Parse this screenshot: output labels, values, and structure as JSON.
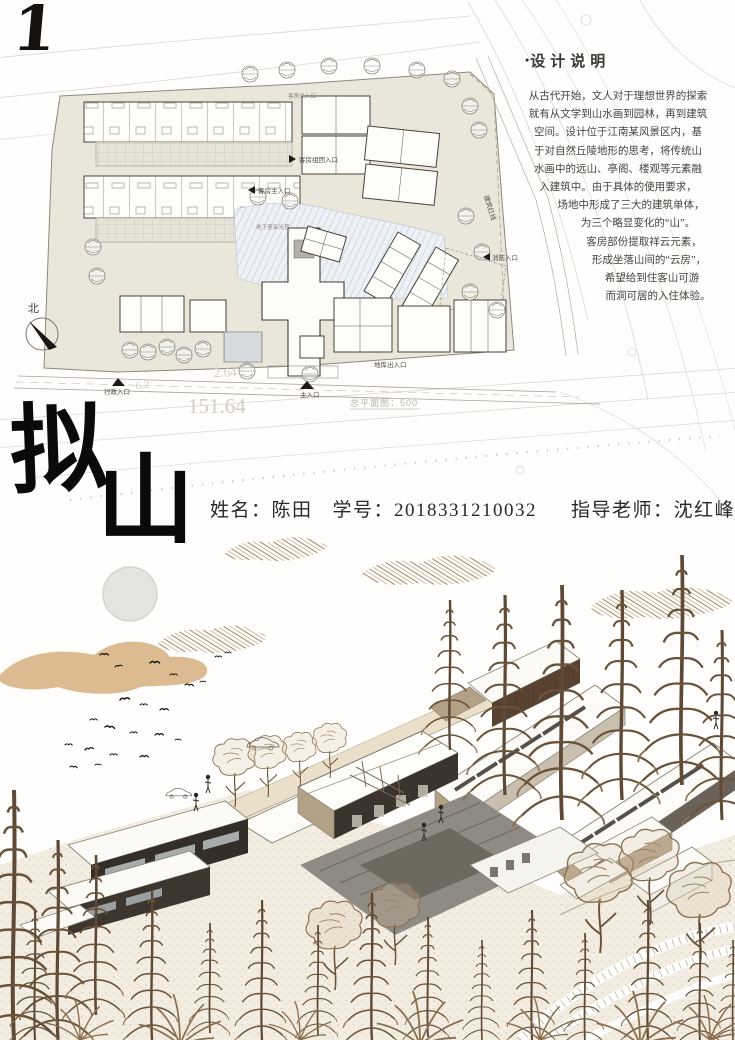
{
  "board": {
    "sheet_number": "1",
    "title": {
      "char1": "拟",
      "char2": "山"
    },
    "student": {
      "name_label": "姓名：",
      "name": "陈田",
      "id_label": "学号：",
      "id": "2018331210032",
      "advisor_label": "指导老师：",
      "advisor": "沈红峰"
    }
  },
  "design_notes": {
    "bullet": "•",
    "title": "设计说明",
    "lines": [
      "从古代开始，文人对于理想世界的探索",
      "就有从文学到山水画到园林，再到建筑",
      "空间。设计位于江南某风景区内，基",
      "于对自然丘陵地形的思考，将传统山",
      "水画中的远山、亭阁、楼观等元素融",
      "入建筑中。由于具体的使用要求，",
      "场地中形成了三大的建筑单体，",
      "为三个略显变化的“山”。",
      "客房部份提取祥云元素，",
      "形成坐落山间的“云房”，",
      "希望给到住客山可游",
      "而洞可居的入住体验。"
    ]
  },
  "site_plan": {
    "north_label": "北",
    "scale_note": "总平面图：500",
    "dimension_frontage": "151.64",
    "dimension_road": "2.64",
    "dimension_small": "6.2",
    "labels": {
      "guest_total_entrance": "客房总入口",
      "guest_cluster_entrance": "客房组团入口",
      "guest_main_entrance": "客房主入口",
      "building_red_line": "建筑红线",
      "fire_entrance": "消防入口",
      "garage_entrance": "地库出入口",
      "basement_skylight": "地下室采光顶",
      "admin_entrance": "行政入口",
      "main_entrance": "主入口"
    }
  },
  "colors": {
    "parcel_beige": "#eae6da",
    "water_blue": "#eef2f6",
    "cloud_tan": "#dcbb91",
    "sketch_brown": "#a5865f",
    "tree_brown": "#6a5238",
    "wall_tan": "#b3a186",
    "wall_dark": "#332e27",
    "terrace_gray": "#8f8a80",
    "ink": "#14110e"
  }
}
